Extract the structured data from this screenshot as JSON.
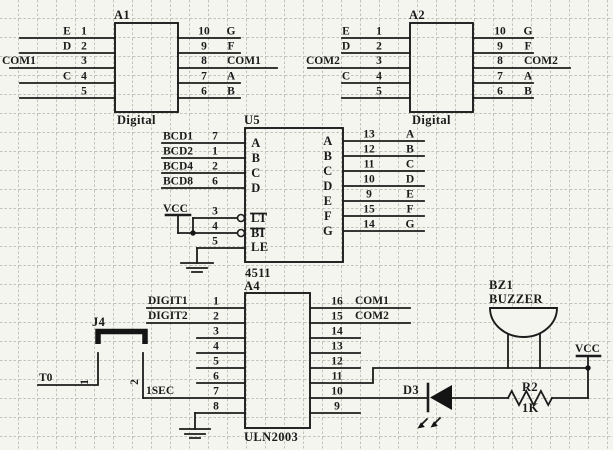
{
  "title": "Digit display driver schematic",
  "colors": {
    "ink": "#1c1c1c",
    "background": "#f4f5ef",
    "grid": "#b7bbb0"
  },
  "a1": {
    "ref": "A1",
    "value": "Digital",
    "left": [
      {
        "name": "E",
        "num": "1"
      },
      {
        "name": "D",
        "num": "2"
      },
      {
        "name": "COM1",
        "num": "3"
      },
      {
        "name": "C",
        "num": "4"
      },
      {
        "name": "",
        "num": "5"
      }
    ],
    "right": [
      {
        "num": "10",
        "name": "G"
      },
      {
        "num": "9",
        "name": "F"
      },
      {
        "num": "8",
        "name": "COM1"
      },
      {
        "num": "7",
        "name": "A"
      },
      {
        "num": "6",
        "name": "B"
      }
    ]
  },
  "a2": {
    "ref": "A2",
    "value": "Digital",
    "left": [
      {
        "name": "E",
        "num": "1"
      },
      {
        "name": "D",
        "num": "2"
      },
      {
        "name": "COM2",
        "num": "3"
      },
      {
        "name": "C",
        "num": "4"
      },
      {
        "name": "",
        "num": "5"
      }
    ],
    "right": [
      {
        "num": "10",
        "name": "G"
      },
      {
        "num": "9",
        "name": "F"
      },
      {
        "num": "8",
        "name": "COM2"
      },
      {
        "num": "7",
        "name": "A"
      },
      {
        "num": "6",
        "name": "B"
      }
    ]
  },
  "u5": {
    "ref": "U5",
    "value": "4511",
    "vcc": "VCC",
    "inputs": [
      {
        "net": "BCD1",
        "num": "7",
        "port": "A"
      },
      {
        "net": "BCD2",
        "num": "1",
        "port": "B"
      },
      {
        "net": "BCD4",
        "num": "2",
        "port": "C"
      },
      {
        "net": "BCD8",
        "num": "6",
        "port": "D"
      }
    ],
    "ctrl": [
      {
        "num": "3",
        "port": "LT"
      },
      {
        "num": "4",
        "port": "BI"
      },
      {
        "num": "5",
        "port": "LE"
      }
    ],
    "outputs": [
      {
        "num": "13",
        "port": "A"
      },
      {
        "num": "12",
        "port": "B"
      },
      {
        "num": "11",
        "port": "C"
      },
      {
        "num": "10",
        "port": "D"
      },
      {
        "num": "9",
        "port": "E"
      },
      {
        "num": "15",
        "port": "F"
      },
      {
        "num": "14",
        "port": "G"
      }
    ]
  },
  "a4": {
    "ref": "A4",
    "value": "ULN2003",
    "left": [
      {
        "net": "DIGIT1",
        "num": "1"
      },
      {
        "net": "DIGIT2",
        "num": "2"
      },
      {
        "num": "3"
      },
      {
        "num": "4"
      },
      {
        "num": "5"
      },
      {
        "num": "6"
      },
      {
        "net": "1SEC",
        "num": "7"
      },
      {
        "num": "8"
      }
    ],
    "right": [
      {
        "num": "16",
        "net": "COM1"
      },
      {
        "num": "15",
        "net": "COM2"
      },
      {
        "num": "14"
      },
      {
        "num": "13"
      },
      {
        "num": "12"
      },
      {
        "num": "11"
      },
      {
        "num": "10"
      },
      {
        "num": "9"
      }
    ]
  },
  "j4": {
    "ref": "J4",
    "pin1": "1",
    "pin2": "2"
  },
  "nets": {
    "t0": "T0",
    "vcc": "VCC"
  },
  "bz1": {
    "ref": "BZ1",
    "value": "BUZZER"
  },
  "d3": {
    "ref": "D3"
  },
  "r2": {
    "ref": "R2",
    "value": "1K"
  }
}
